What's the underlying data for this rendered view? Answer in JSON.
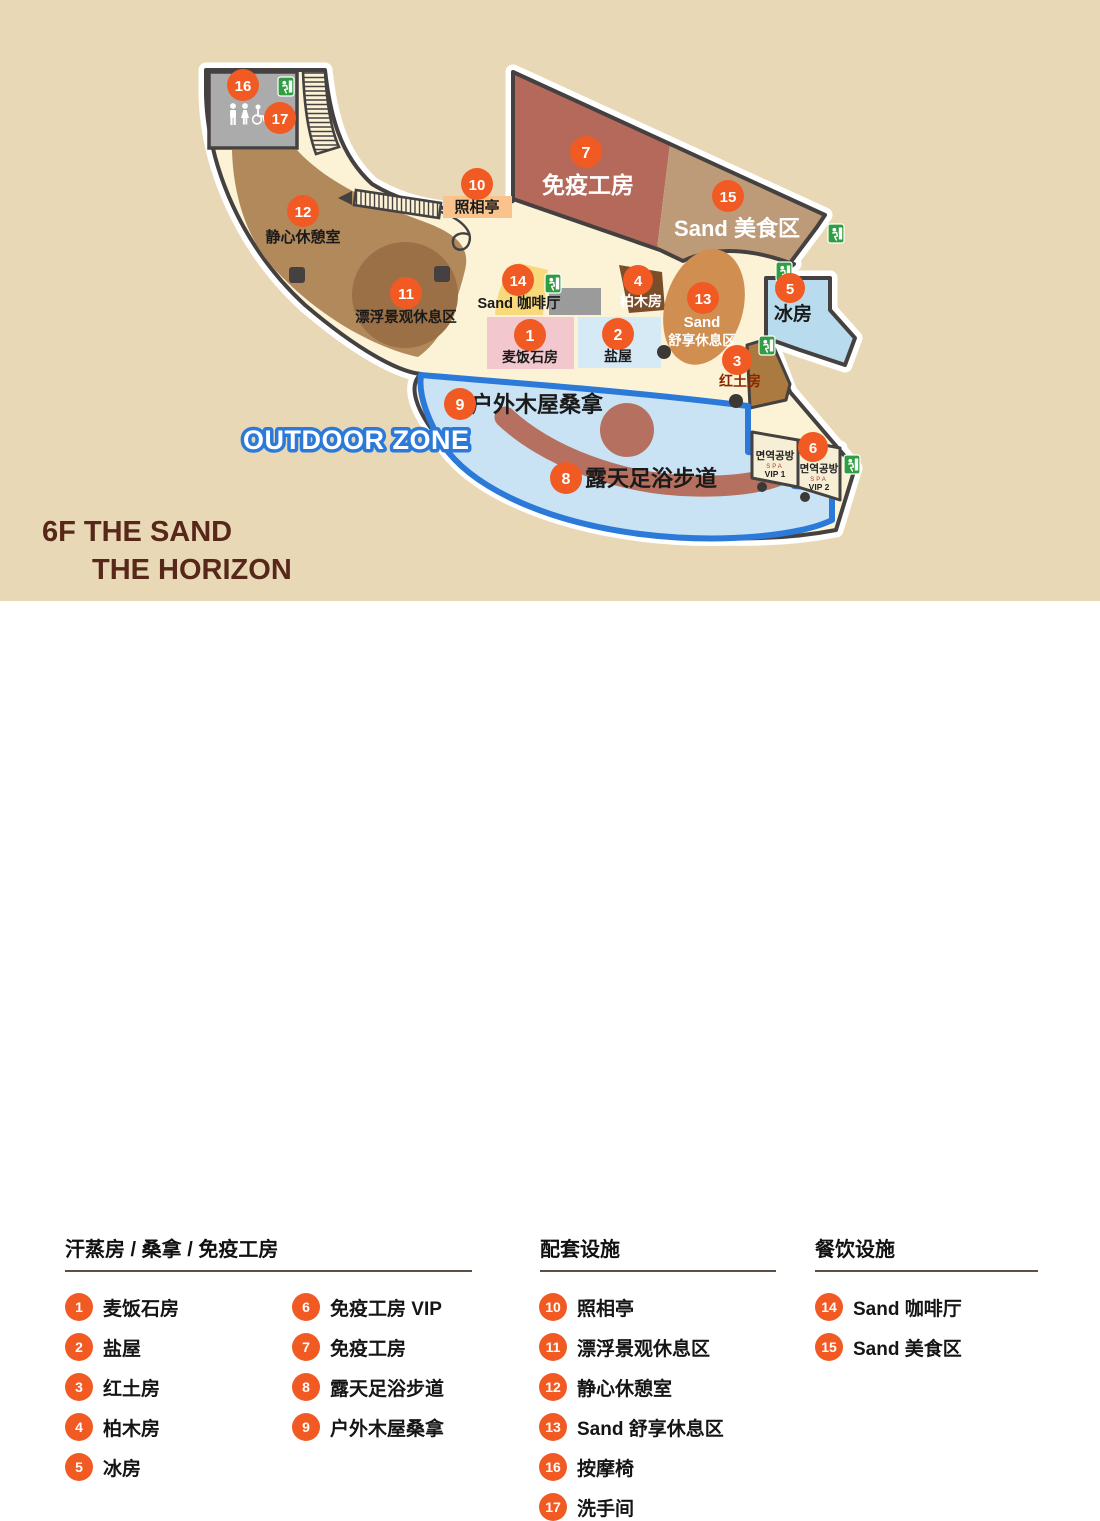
{
  "map": {
    "title": {
      "line1": "6F  THE SAND",
      "line2": "THE HORIZON"
    },
    "outdoor_label": "OUTDOOR ZONE",
    "rooms": {
      "r1": "麦饭石房",
      "r2": "盐屋",
      "r3": "红土房",
      "r4": "柏木房",
      "r5": "冰房",
      "r7": "免疫工房",
      "r8": "露天足浴步道",
      "r9": "户外木屋桑拿",
      "r10": "照相亭",
      "r11": "漂浮景观休息区",
      "r12": "静心休憩室",
      "r13_line1": "Sand",
      "r13_line2": "舒享休息区",
      "r14": "Sand 咖啡厅",
      "r15": "Sand 美食区",
      "vip1_name": "면역공방",
      "vip1_sub": "SPA",
      "vip1_tag": "VIP 1",
      "vip2_name": "면역공방",
      "vip2_sub": "SPA",
      "vip2_tag": "VIP 2"
    },
    "markers": {
      "m1": "1",
      "m2": "2",
      "m3": "3",
      "m4": "4",
      "m5": "5",
      "m6": "6",
      "m7": "7",
      "m8": "8",
      "m9": "9",
      "m10": "10",
      "m11": "11",
      "m12": "12",
      "m13": "13",
      "m14": "14",
      "m15": "15",
      "m16": "16",
      "m17": "17"
    }
  },
  "legend": {
    "sections": [
      {
        "title": "汗蒸房 / 桑拿 / 免疫工房",
        "items": [
          {
            "num": "1",
            "label": "麦饭石房"
          },
          {
            "num": "2",
            "label": "盐屋"
          },
          {
            "num": "3",
            "label": "红土房"
          },
          {
            "num": "4",
            "label": "柏木房"
          },
          {
            "num": "5",
            "label": "冰房"
          },
          {
            "num": "6",
            "label": "免疫工房 VIP"
          },
          {
            "num": "7",
            "label": "免疫工房"
          },
          {
            "num": "8",
            "label": "露天足浴步道"
          },
          {
            "num": "9",
            "label": "户外木屋桑拿"
          }
        ]
      },
      {
        "title": "配套设施",
        "items": [
          {
            "num": "10",
            "label": "照相亭"
          },
          {
            "num": "11",
            "label": "漂浮景观休息区"
          },
          {
            "num": "12",
            "label": "静心休憩室"
          },
          {
            "num": "13",
            "label": "Sand 舒享休息区"
          },
          {
            "num": "16",
            "label": "按摩椅"
          },
          {
            "num": "17",
            "label": "洗手间"
          }
        ]
      },
      {
        "title": "餐饮设施",
        "items": [
          {
            "num": "14",
            "label": "Sand 咖啡厅"
          },
          {
            "num": "15",
            "label": "Sand 美食区"
          }
        ]
      }
    ]
  },
  "colors": {
    "marker_orange": "#f15a22",
    "outdoor_blue": "#2b79d8",
    "exit_green": "#2f9e41",
    "map_bg_tan": "#e9d8b5",
    "floor_cream": "#fcf3d7",
    "outline_dark": "#454140",
    "title_maroon": "#57281a"
  }
}
